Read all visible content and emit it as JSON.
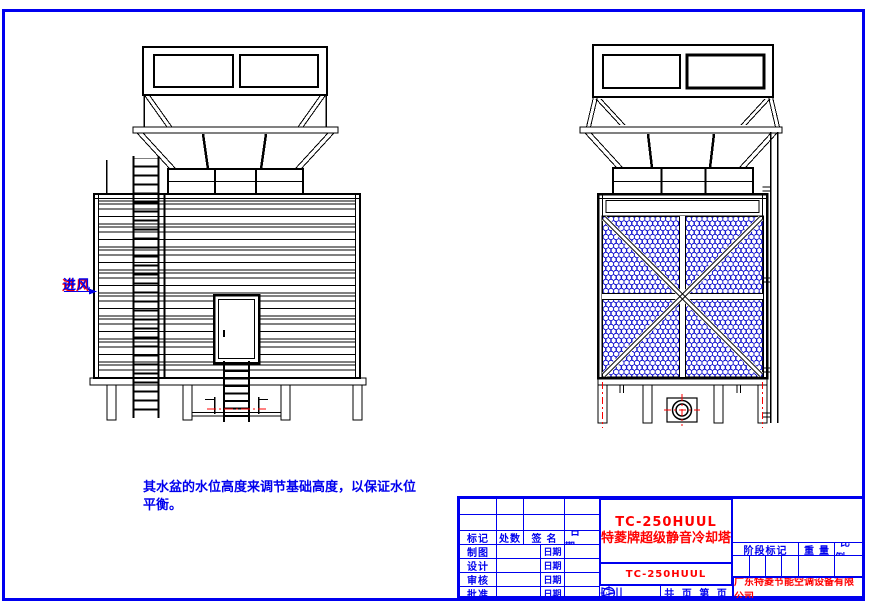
{
  "colors": {
    "frame_blue": "#0000f0",
    "line_black": "#000000",
    "annotation_blue": "#0000ee",
    "annotation_red": "#ff0000",
    "mesh_blue": "#1414cf"
  },
  "labels": {
    "air_inlet": "进风"
  },
  "note": {
    "line1": "其水盆的水位高度来调节基础高度，以保证水位",
    "line2": "平衡。"
  },
  "title_block": {
    "revision_headers": [
      "标记",
      "处数",
      "签名",
      "日期"
    ],
    "rows": [
      {
        "label": "制图",
        "date_label": "日期"
      },
      {
        "label": "设计",
        "date_label": "日期"
      },
      {
        "label": "审核",
        "date_label": "日期"
      },
      {
        "label": "批准",
        "date_label": "日期"
      }
    ],
    "product_model": "TC-250HUUL",
    "product_name": "特菱牌超级静音冷却塔",
    "model_repeat": "TC-250HUUL",
    "pages_label": "共  页 第  页",
    "stage_header": "阶段标记",
    "weight_header": "重量",
    "scale_header": "比例",
    "company": "广东特菱节能空调设备有限公司"
  }
}
